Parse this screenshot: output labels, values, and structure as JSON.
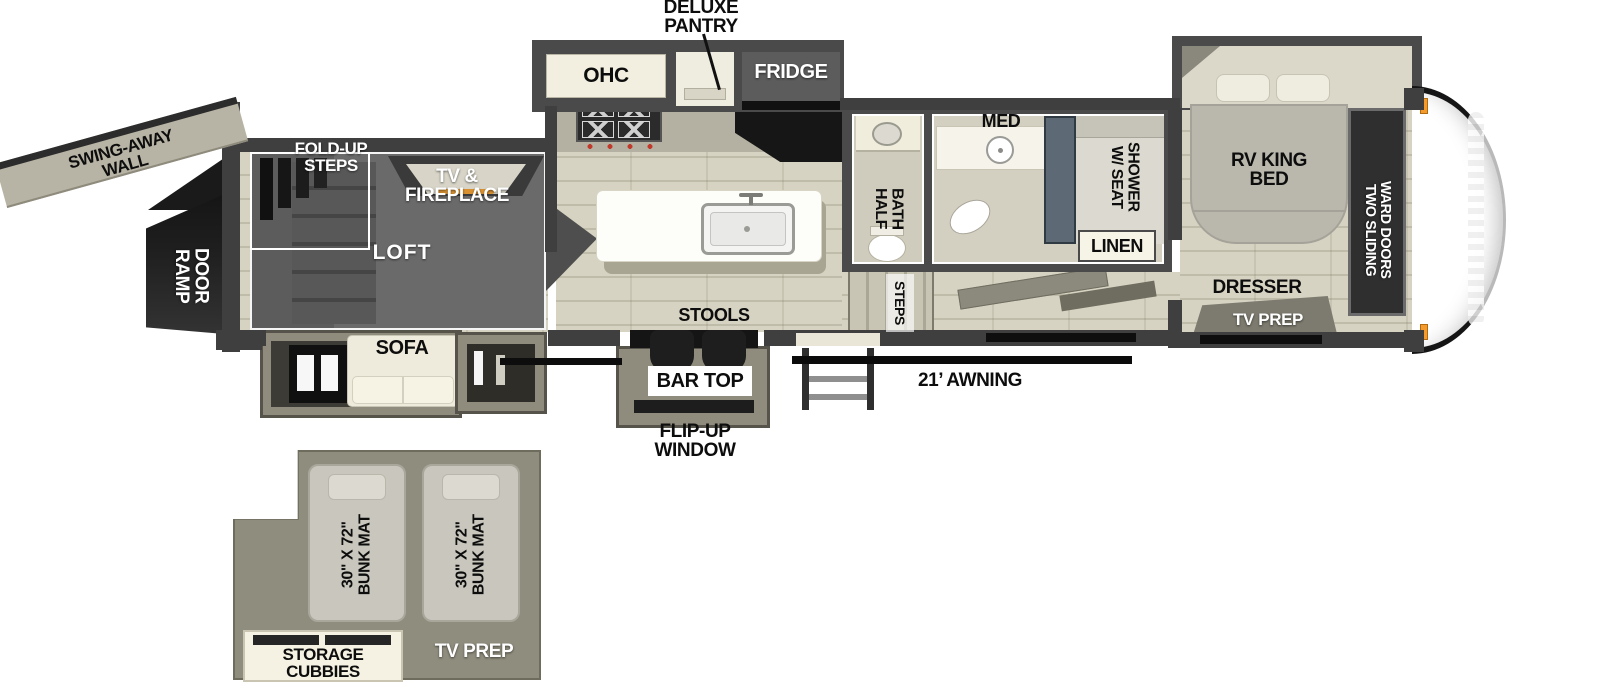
{
  "title": "Travel trailer toy hauler floor plan",
  "colors": {
    "wall_dark": "#3f3f3f",
    "floor_beige": "#d7d3c2",
    "loft_gray": "#6a6a6a",
    "slide_wall": "#8f8c7d",
    "cabinet_cream": "#f3efe0",
    "appliance_gray": "#5c5c5c",
    "counter_black": "#161616",
    "bunk_area_olive": "#8f8d7d",
    "marker_orange": "#f49b2c",
    "fireplace_glow": "#d89030"
  },
  "labels": {
    "deluxe_pantry": "DELUXE\nPANTRY",
    "ohc": "OHC",
    "fridge": "FRIDGE",
    "med": "MED",
    "shower_w_seat": "SHOWER\nW/ SEAT",
    "linen": "LINEN",
    "half_bath": "HALF\nBATH",
    "rv_king_bed": "RV KING\nBED",
    "two_sliding_ward_doors": "TWO SLIDING\nWARD DOORS",
    "dresser": "DRESSER",
    "tv_prep_bedroom": "TV PREP",
    "swing_away_wall": "SWING-AWAY\nWALL",
    "fold_up_steps": "FOLD-UP\nSTEPS",
    "tv_fireplace": "TV &\nFIREPLACE",
    "ramp_door": "RAMP\nDOOR",
    "loft": "LOFT",
    "sofa": "SOFA",
    "stools": "STOOLS",
    "steps": "STEPS",
    "bar_top": "BAR TOP",
    "flip_up_window": "FLIP-UP\nWINDOW",
    "awning": "21’ AWNING",
    "bunk_mat_1": "30\" X 72\"\nBUNK MAT",
    "bunk_mat_2": "30\" X 72\"\nBUNK MAT",
    "storage_cubbies": "STORAGE\nCUBBIES",
    "tv_prep_loft": "TV PREP"
  }
}
